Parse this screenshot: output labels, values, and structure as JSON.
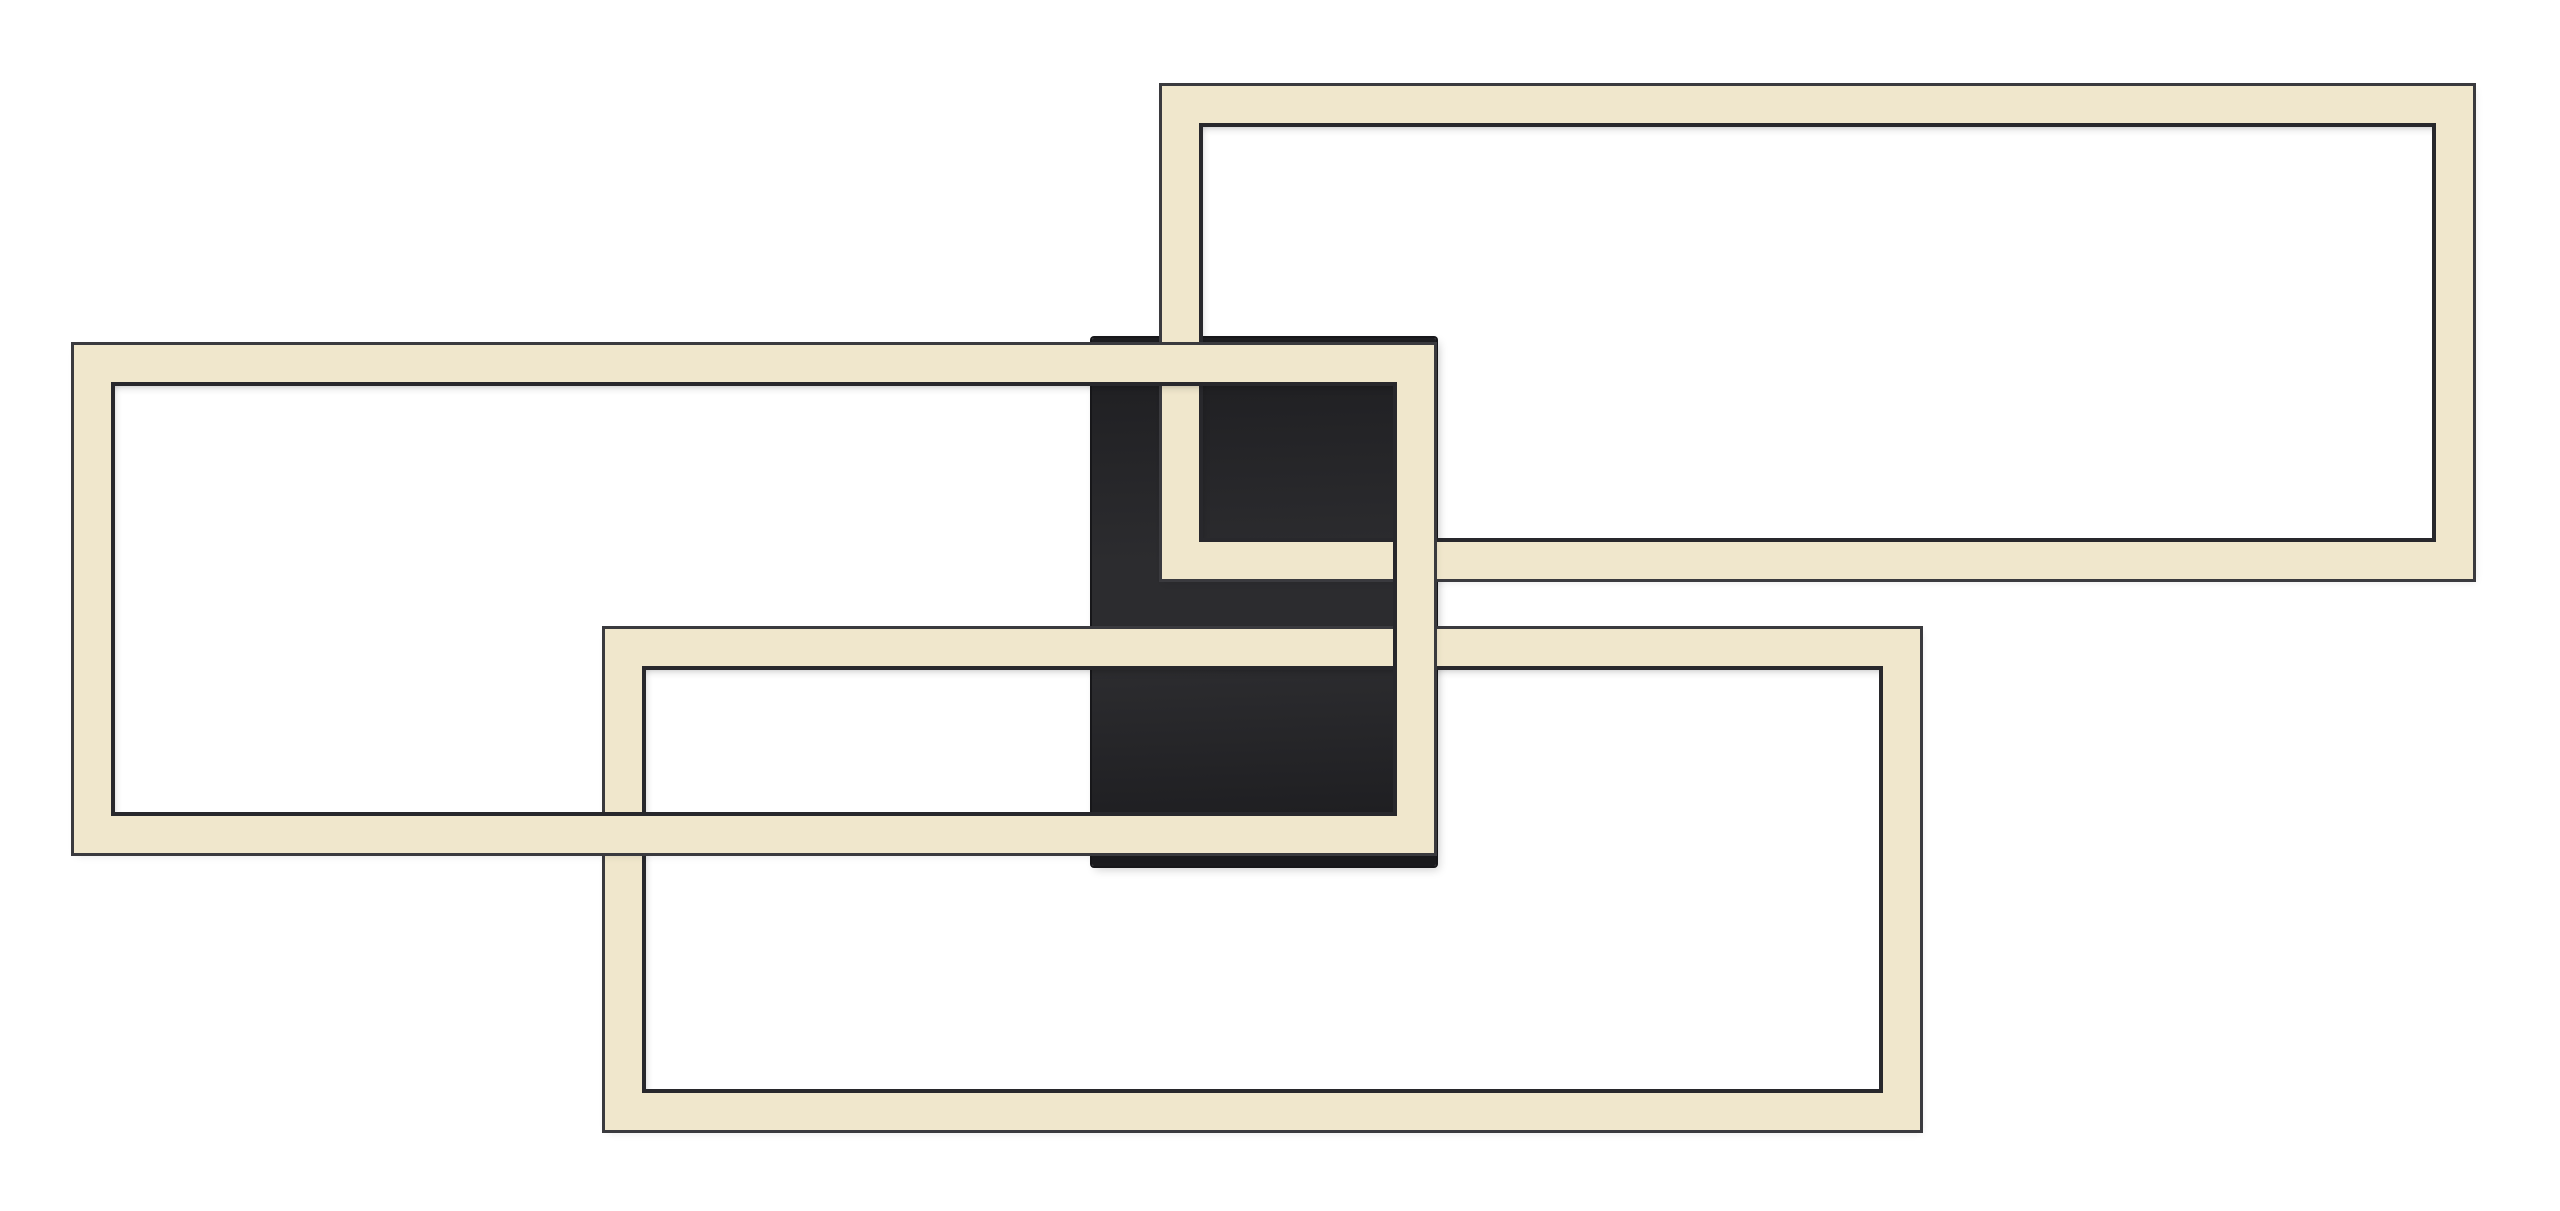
{
  "meta": {
    "subject": "modern-rectangular-led-ceiling-light-product-photo",
    "canvas": {
      "width": 2560,
      "height": 1211
    },
    "background_color": "#ffffff"
  },
  "palette": {
    "led_band": "#f0e7cc",
    "band_edge_outer": "#3a3a3e",
    "band_edge_inner": "#28282c",
    "canopy_gradient_top": "#1d1d20",
    "canopy_gradient_mid": "#2c2c2f",
    "canopy_gradient_bottom": "#1a1a1d"
  },
  "fixture": {
    "canopy": {
      "x": 1092,
      "y": 338,
      "width": 344,
      "height": 528,
      "z": 1
    },
    "frames": [
      {
        "id": "led-frame-upper-right",
        "x": 1162,
        "y": 86,
        "width": 1311,
        "height": 493,
        "band": 37,
        "z": 2
      },
      {
        "id": "led-frame-lower-center",
        "x": 605,
        "y": 629,
        "width": 1315,
        "height": 501,
        "band": 37,
        "z": 3
      },
      {
        "id": "led-frame-left",
        "x": 74,
        "y": 345,
        "width": 1360,
        "height": 508,
        "band": 37,
        "z": 4
      }
    ]
  }
}
